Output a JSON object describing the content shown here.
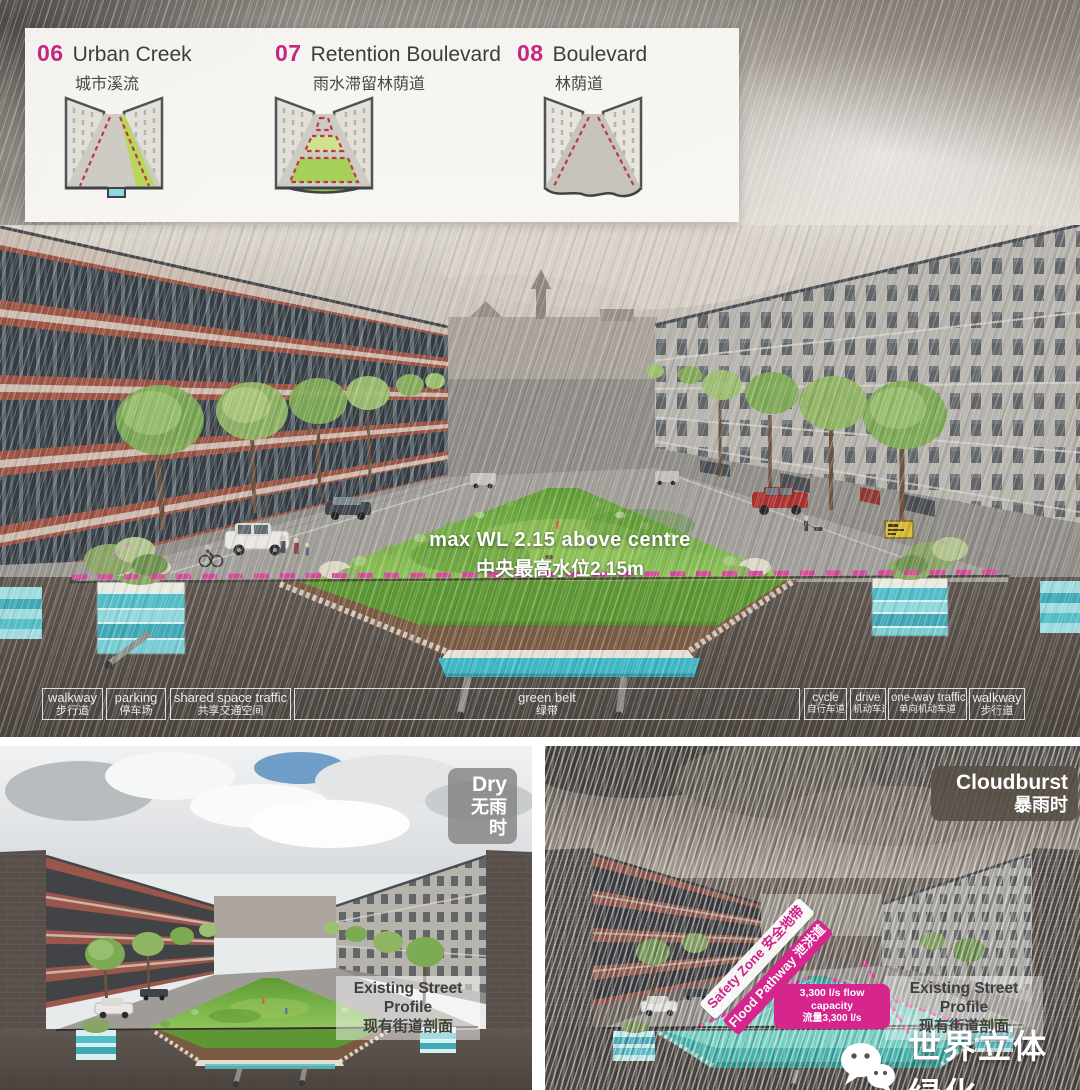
{
  "colors": {
    "magenta": "#c5267f",
    "pink_dash": "#d8499c",
    "water_teal": "#49bcb4",
    "lawn_green": "#6aa53c",
    "earth": "#59504b"
  },
  "legend": {
    "items": [
      {
        "number": "06",
        "title": "Urban Creek",
        "subtitle": "城市溪流",
        "icon": "urban-creek-section-icon"
      },
      {
        "number": "07",
        "title": "Retention Boulevard",
        "subtitle": "雨水滞留林荫道",
        "icon": "retention-boulevard-section-icon"
      },
      {
        "number": "08",
        "title": "Boulevard",
        "subtitle": "林荫道",
        "icon": "boulevard-section-icon"
      }
    ]
  },
  "main_render": {
    "water_level": {
      "en": "max WL 2.15 above centre",
      "cn": "中央最高水位2.15m"
    },
    "zones": [
      {
        "en": "walkway",
        "cn": "步行道"
      },
      {
        "en": "parking",
        "cn": "停车场"
      },
      {
        "en": "shared space traffic",
        "cn": "共享交通空间"
      },
      {
        "en": "green belt",
        "cn": "绿带"
      },
      {
        "en": "cycle",
        "cn": "自行车道"
      },
      {
        "en": "drive",
        "cn": "机动车道"
      },
      {
        "en": "one-way traffic",
        "cn": "单向机动车道"
      },
      {
        "en": "walkway",
        "cn": "步行道"
      }
    ]
  },
  "dry_panel": {
    "badge": {
      "en": "Dry",
      "cn": "无雨时"
    },
    "existing_profile": {
      "en": "Existing Street Profile",
      "cn": "现有街道剖面"
    }
  },
  "cloudburst_panel": {
    "badge": {
      "en": "Cloudburst",
      "cn": "暴雨时"
    },
    "safety_zone": {
      "en": "Safety Zone",
      "cn": "安全地带"
    },
    "flood_pathway": {
      "en": "Flood Pathway",
      "cn": "泄洪道"
    },
    "flow_capacity": {
      "en": "3,300 l/s flow capacity",
      "cn": "流量3,300 l/s"
    },
    "existing_profile": {
      "en": "Existing Street Profile",
      "cn": "现有街道剖面"
    }
  },
  "watermark": {
    "text": "世界立体绿化",
    "icon": "wechat-icon"
  }
}
